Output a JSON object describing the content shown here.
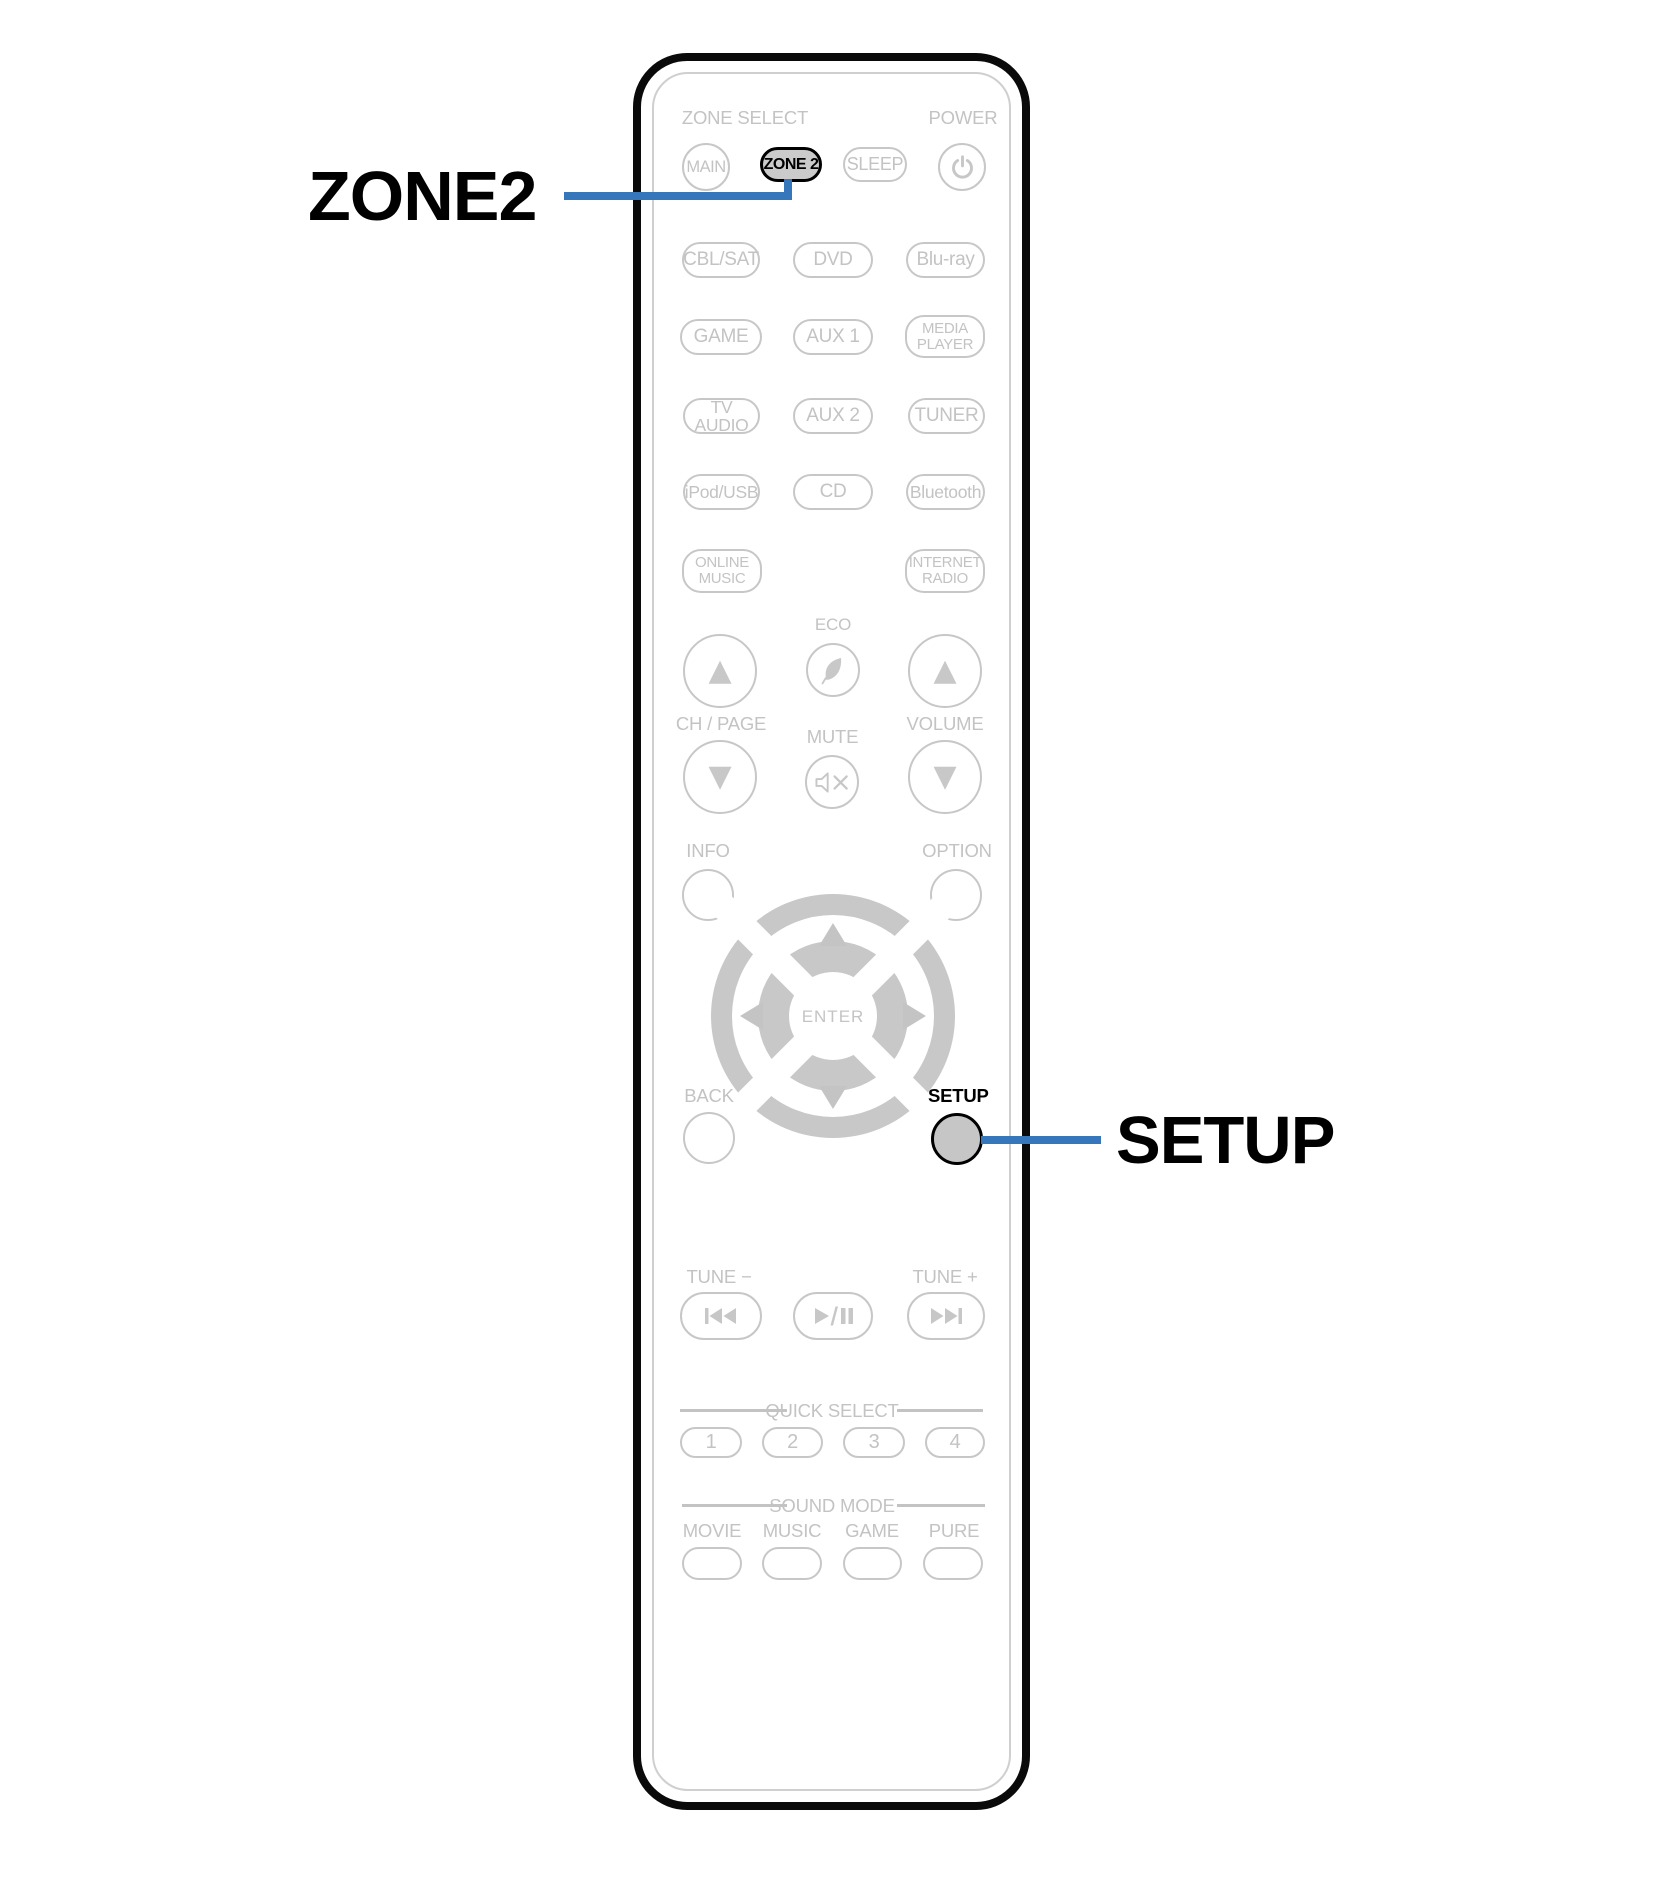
{
  "colors": {
    "accent_blue": "#3577ba",
    "outline_gray": "#c7c7c7",
    "label_gray": "#c3c3c3",
    "highlight_button_fill": "#cbcbcb",
    "remote_border": "#0a0a0a"
  },
  "callouts": {
    "zone2": "ZONE2",
    "setup": "SETUP"
  },
  "icons": {
    "up_triangle": "▲",
    "down_triangle": "▼"
  },
  "remote": {
    "header": {
      "zone_select": "ZONE SELECT",
      "power": "POWER",
      "main": "MAIN",
      "zone2": "ZONE 2",
      "sleep": "SLEEP"
    },
    "sources": {
      "row1": [
        "CBL/SAT",
        "DVD",
        "Blu-ray"
      ],
      "row2": [
        "GAME",
        "AUX 1",
        "MEDIA\nPLAYER"
      ],
      "row3": [
        "TV AUDIO",
        "AUX 2",
        "TUNER"
      ],
      "row4": [
        "iPod/USB",
        "CD",
        "Bluetooth"
      ],
      "row5": [
        "ONLINE\nMUSIC",
        "INTERNET\nRADIO"
      ]
    },
    "center": {
      "eco": "ECO",
      "ch_page": "CH / PAGE",
      "mute": "MUTE",
      "volume": "VOLUME",
      "info": "INFO",
      "option": "OPTION"
    },
    "dpad": {
      "enter": "ENTER"
    },
    "nav": {
      "back": "BACK",
      "setup": "SETUP"
    },
    "transport": {
      "tune_minus": "TUNE −",
      "tune_plus": "TUNE +"
    },
    "quick_select": {
      "title": "QUICK SELECT",
      "buttons": [
        "1",
        "2",
        "3",
        "4"
      ]
    },
    "sound_mode": {
      "title": "SOUND MODE",
      "labels": [
        "MOVIE",
        "MUSIC",
        "GAME",
        "PURE"
      ]
    }
  }
}
